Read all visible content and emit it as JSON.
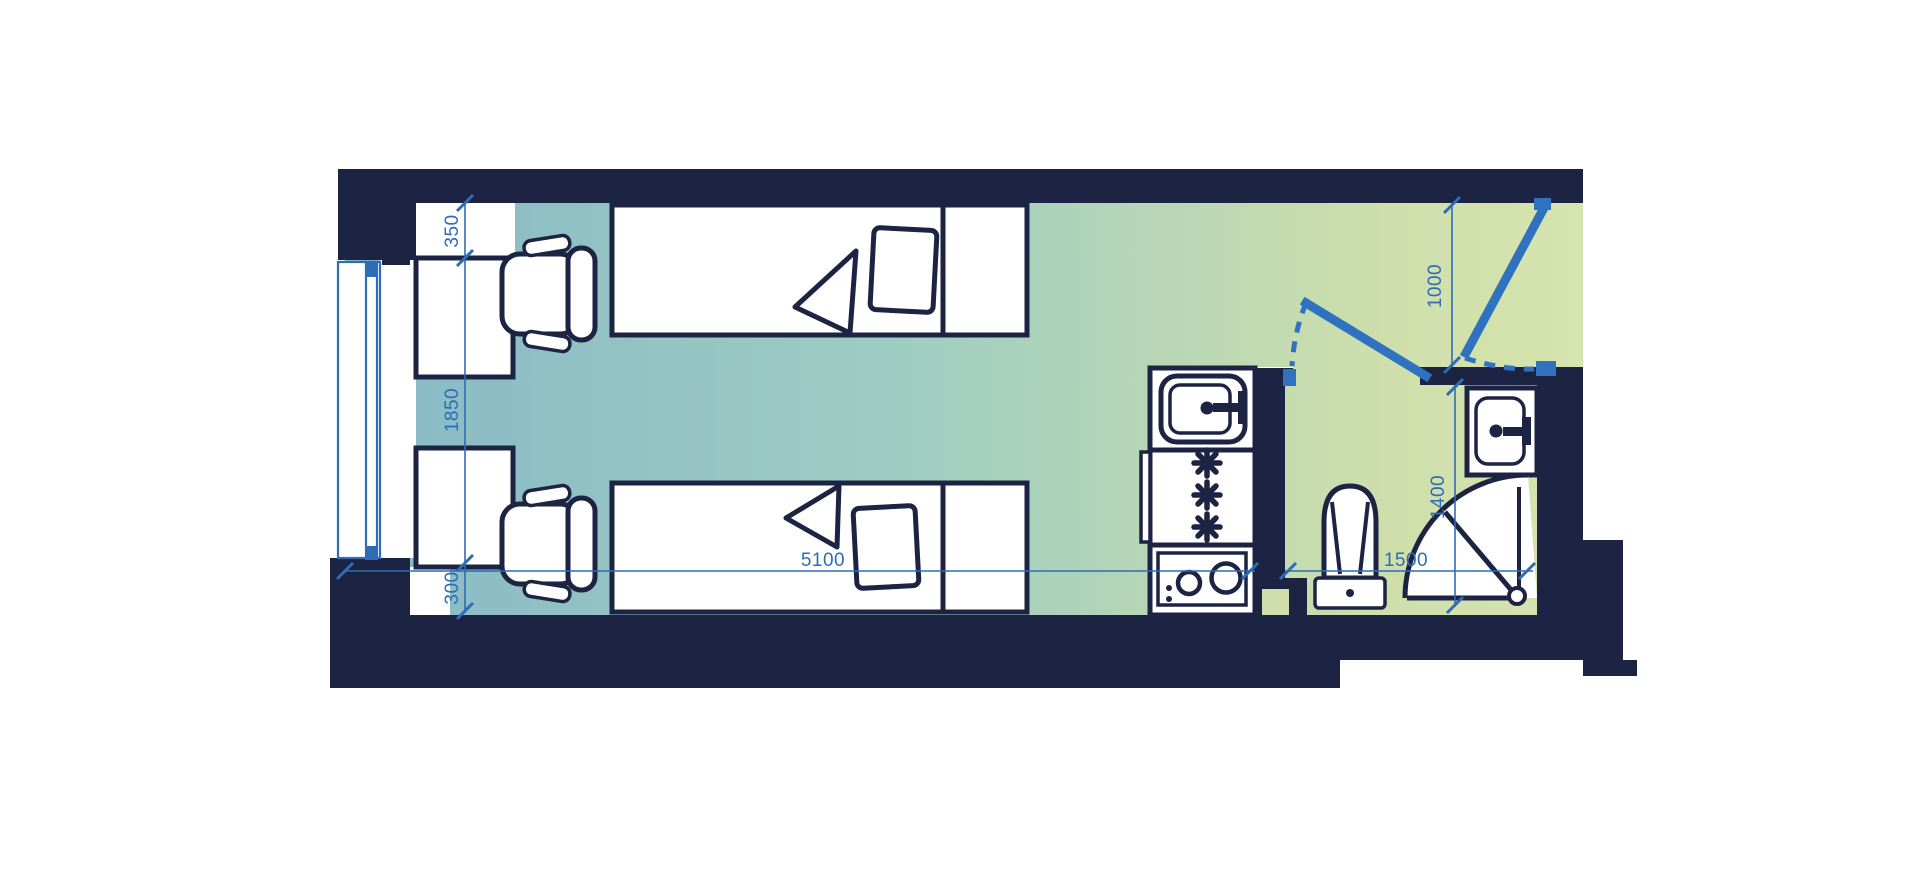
{
  "page": {
    "kind": "studio apartment floor plan"
  },
  "floor_plan": {
    "dimensions": {
      "desk_clearance": "350",
      "window_bay": "1850",
      "bed_clearance": "300",
      "room_length": "5100",
      "entry_opening": "1000",
      "bathroom_length": "1400",
      "bathroom_width": "1500"
    },
    "colors": {
      "wall": "#1d2343",
      "dimension_blue": "#2e6cb5",
      "door_blue": "#2f72c0",
      "floor_teal_left": "#88b8c6",
      "floor_teal_mid": "#9ecdc2",
      "floor_green_right": "#d6e4ae"
    },
    "fixtures": [
      "window",
      "desk",
      "task-chair",
      "single-bed",
      "pillow",
      "blanket",
      "bedside-cabinet",
      "kitchen-sink",
      "fridge-freezer",
      "two-burner-hob",
      "bathroom-door",
      "entrance-door",
      "toilet",
      "wash-basin",
      "corner-shower"
    ]
  }
}
